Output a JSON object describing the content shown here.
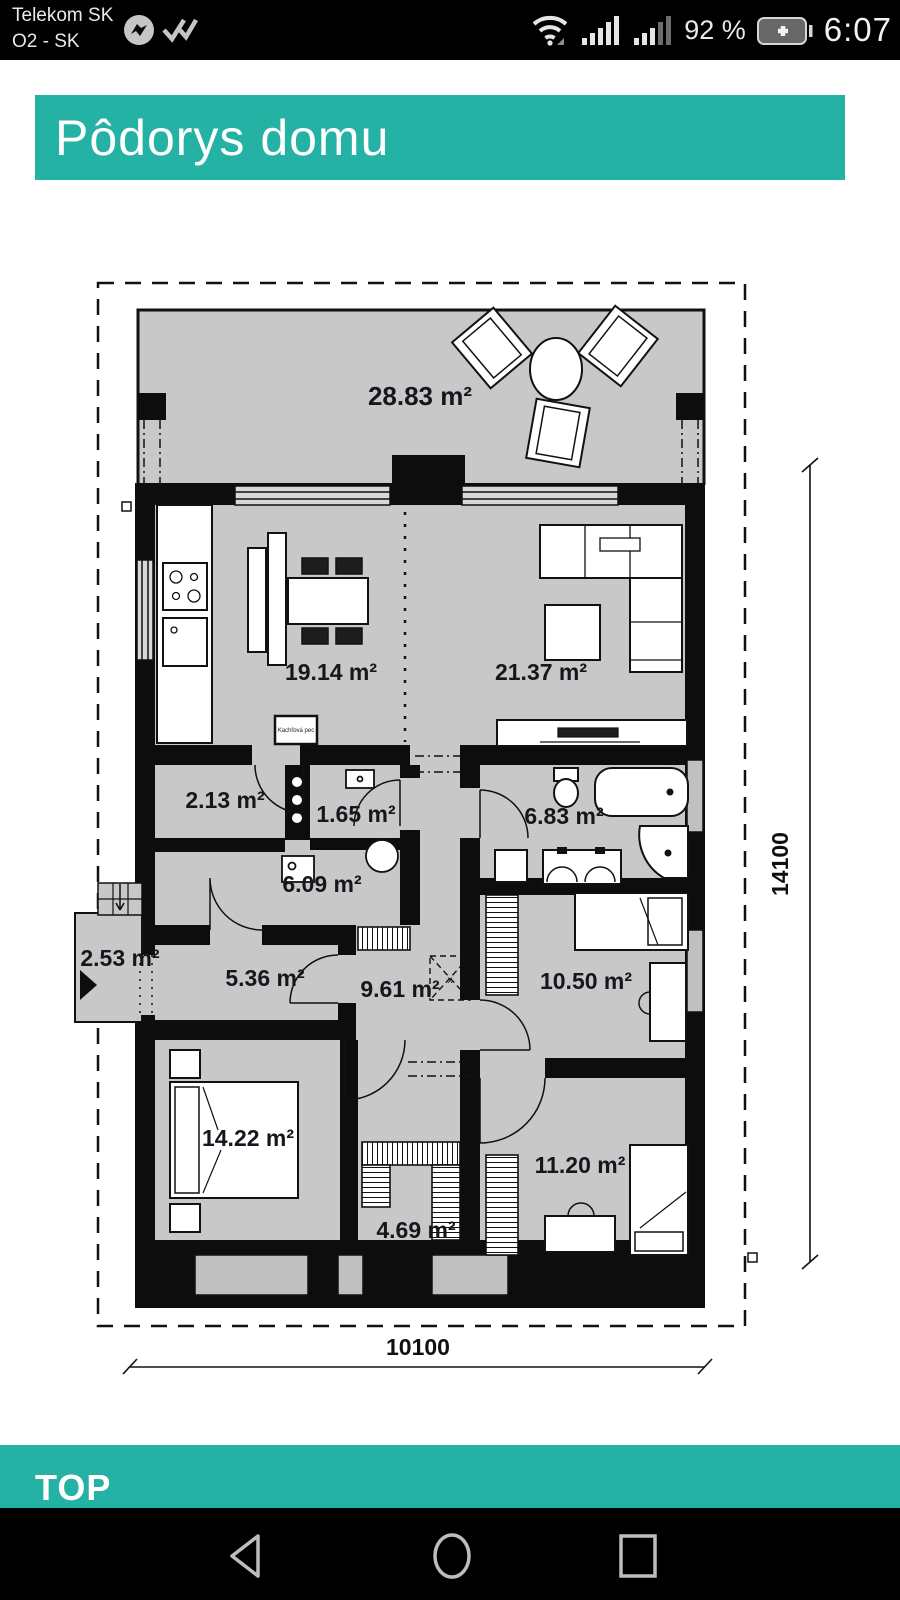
{
  "status_bar": {
    "carrier_line1": "Telekom SK",
    "carrier_line2": "O2 - SK",
    "battery_percent": "92 %",
    "time": "6:07"
  },
  "header": {
    "title": "Pôdorys domu"
  },
  "plan": {
    "rooms": [
      {
        "name": "terrace",
        "area": "28.83 m²"
      },
      {
        "name": "kitchen-dining",
        "area": "19.14 m²"
      },
      {
        "name": "living-room",
        "area": "21.37 m²"
      },
      {
        "name": "entry-closet",
        "area": "2.13 m²"
      },
      {
        "name": "wc",
        "area": "1.65 m²"
      },
      {
        "name": "bathroom",
        "area": "6.83 m²"
      },
      {
        "name": "utility-room",
        "area": "6.09 m²"
      },
      {
        "name": "porch",
        "area": "2.53 m²"
      },
      {
        "name": "hall",
        "area": "5.36 m²"
      },
      {
        "name": "corridor",
        "area": "9.61 m²"
      },
      {
        "name": "bedroom-right",
        "area": "10.50 m²"
      },
      {
        "name": "master-bedroom",
        "area": "14.22 m²"
      },
      {
        "name": "walk-in-closet",
        "area": "4.69 m²"
      },
      {
        "name": "bedroom-bottom",
        "area": "11.20 m²"
      }
    ],
    "annotations": {
      "stove_label": "Kachľová pec",
      "attic_label": "x"
    },
    "dimensions": {
      "height_mm": "14100",
      "width_mm": "10100"
    }
  },
  "footer": {
    "section_label": "TOP"
  },
  "colors": {
    "accent": "#24b2a4",
    "wall": "#0d0d0d",
    "floor": "#c8c8c8"
  }
}
